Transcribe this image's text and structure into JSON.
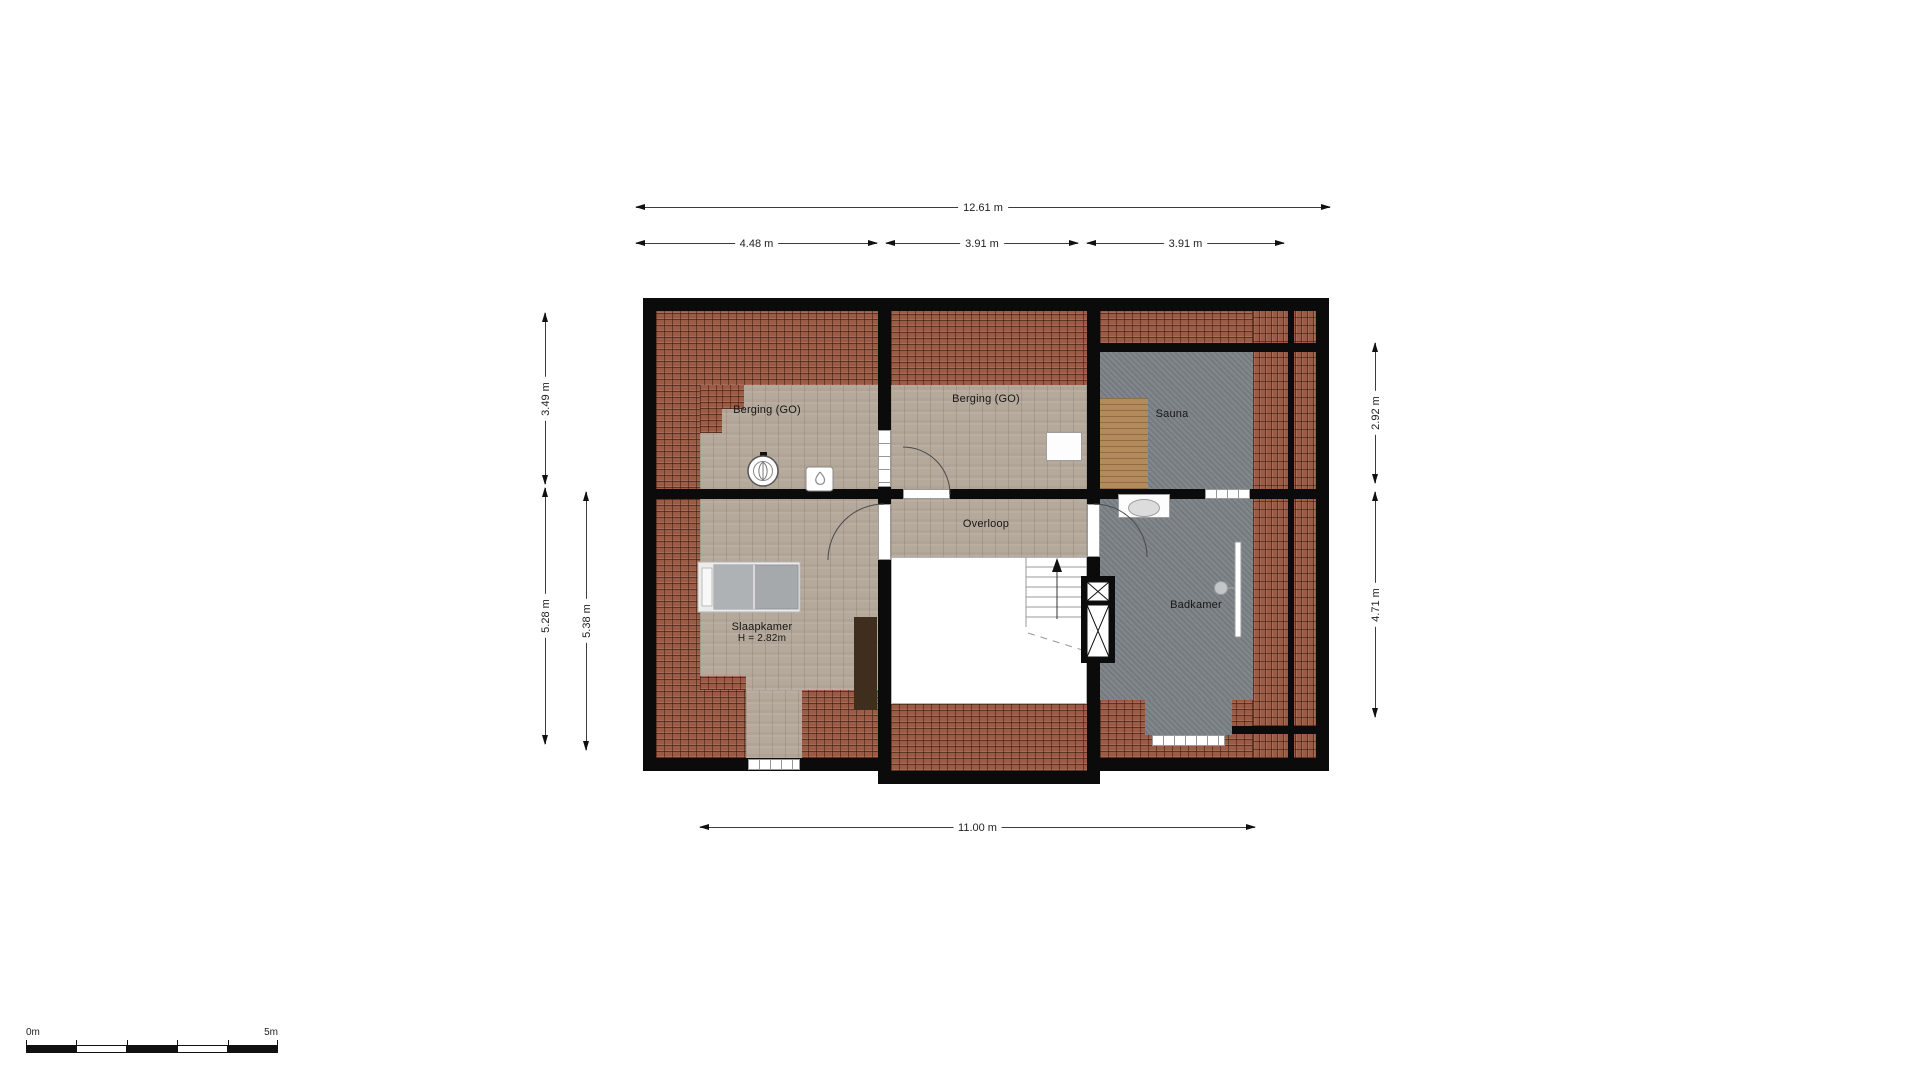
{
  "rooms": {
    "berging_left": "Berging (GO)",
    "berging_middle": "Berging (GO)",
    "sauna": "Sauna",
    "overloop": "Overloop",
    "slaapkamer": "Slaapkamer",
    "slaapkamer_height": "H = 2.82m",
    "badkamer": "Badkamer"
  },
  "dimensions": {
    "total_width": "12.61 m",
    "top_segment_left": "4.48 m",
    "top_segment_middle": "3.91 m",
    "top_segment_right": "3.91 m",
    "left_outer_upper": "3.49 m",
    "left_outer_lower": "5.28 m",
    "left_inner": "5.38 m",
    "right_upper": "2.92 m",
    "right_lower": "4.71 m",
    "bottom_width": "11.00 m"
  },
  "scale_bar": {
    "start_label": "0m",
    "end_label": "5m"
  },
  "fixtures": [
    "bed",
    "wardrobe",
    "mechanical-ventilation-unit",
    "boiler",
    "staircase",
    "flue-shaft",
    "washbasin",
    "shower",
    "sauna-bench",
    "dormer-window"
  ],
  "colors": {
    "wall": "#0b0b0b",
    "roof_tiles": "#9c5b45",
    "wood_floor": "#b5a99b",
    "bathroom_floor": "#7b8186",
    "sauna_bench_wood": "#b28a5c"
  }
}
